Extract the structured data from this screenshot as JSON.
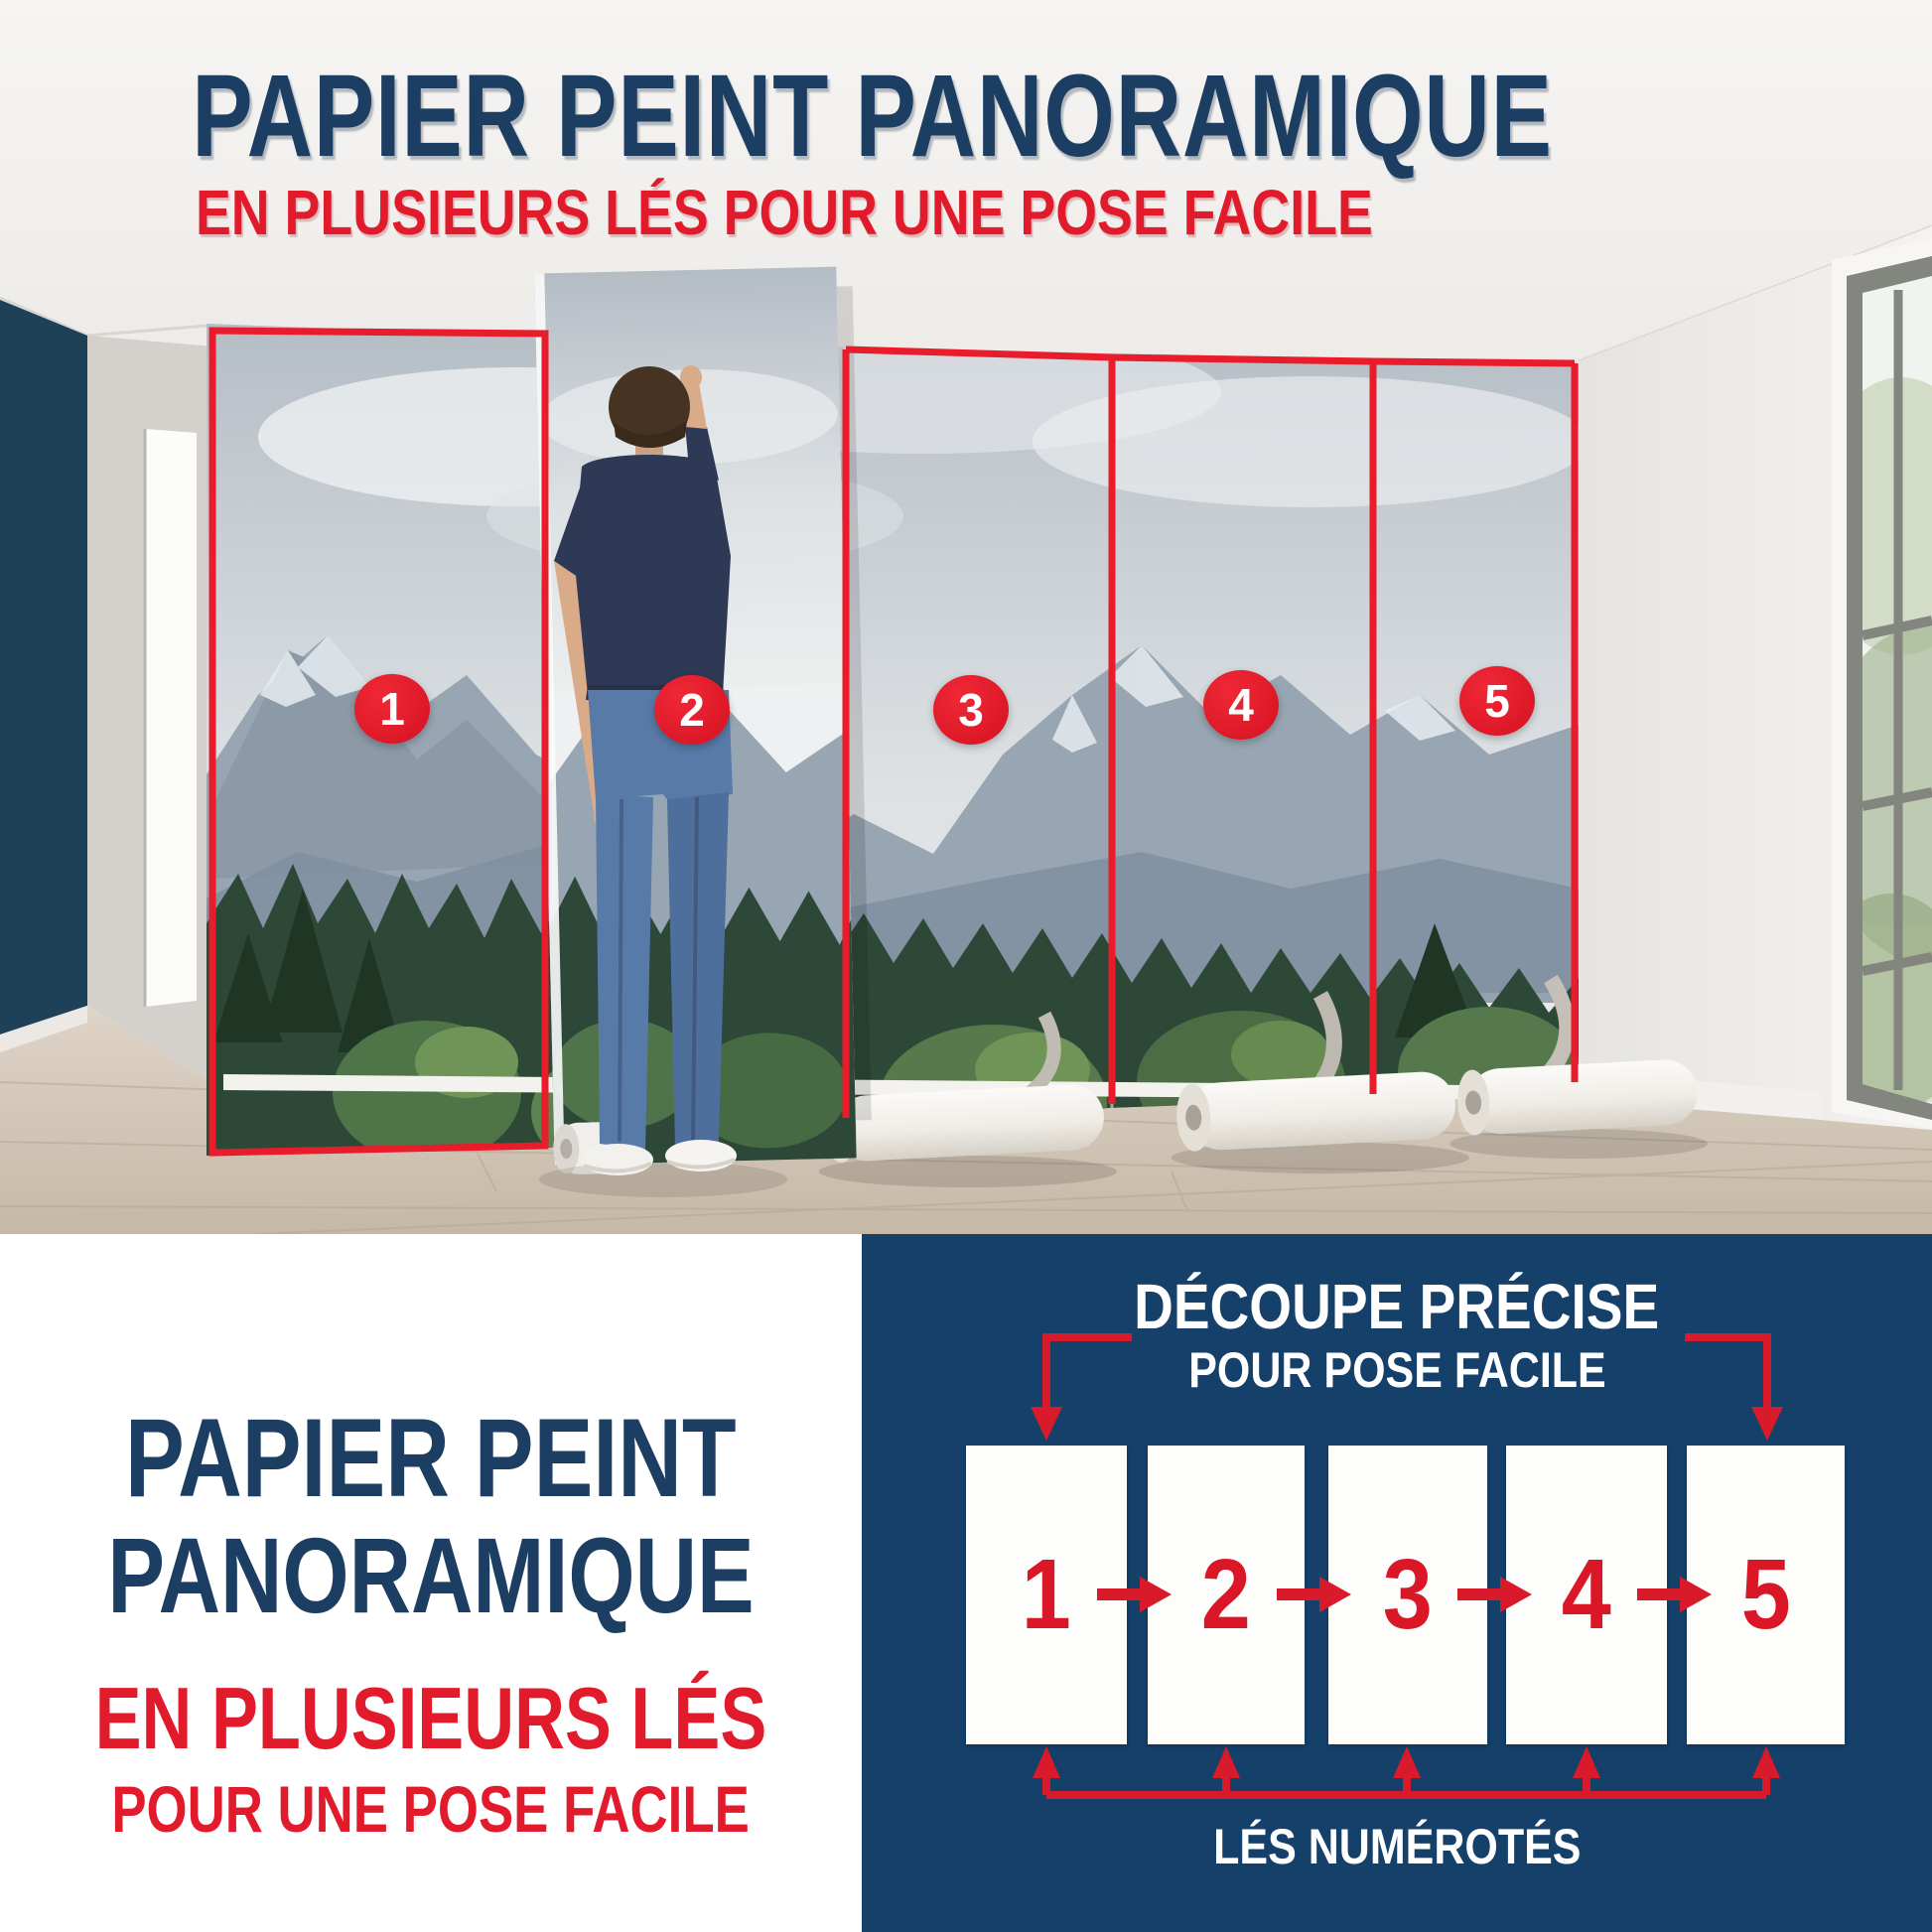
{
  "colors": {
    "navy_text": "#1c3e63",
    "red": "#e21b2c",
    "panel_navy": "#15406a",
    "accent_wall": "#1e4158",
    "mural_sky": "#c3cad1",
    "forest_green": "#2e4837",
    "floor_wood": "#d3c8ba"
  },
  "header": {
    "title": "PAPIER PEINT PANORAMIQUE",
    "subtitle": "EN PLUSIEURS LÉS POUR UNE POSE FACILE"
  },
  "photo": {
    "strip_labels": [
      "1",
      "2",
      "3",
      "4",
      "5"
    ]
  },
  "bottom_left": {
    "line1": "PAPIER PEINT",
    "line2": "PANORAMIQUE",
    "line3": "EN PLUSIEURS LÉS",
    "line4": "POUR UNE POSE FACILE"
  },
  "diagram": {
    "title_line1": "DÉCOUPE PRÉCISE",
    "title_line2": "POUR POSE FACILE",
    "strip_numbers": [
      "1",
      "2",
      "3",
      "4",
      "5"
    ],
    "footer_label": "LÉS NUMÉROTÉS"
  }
}
